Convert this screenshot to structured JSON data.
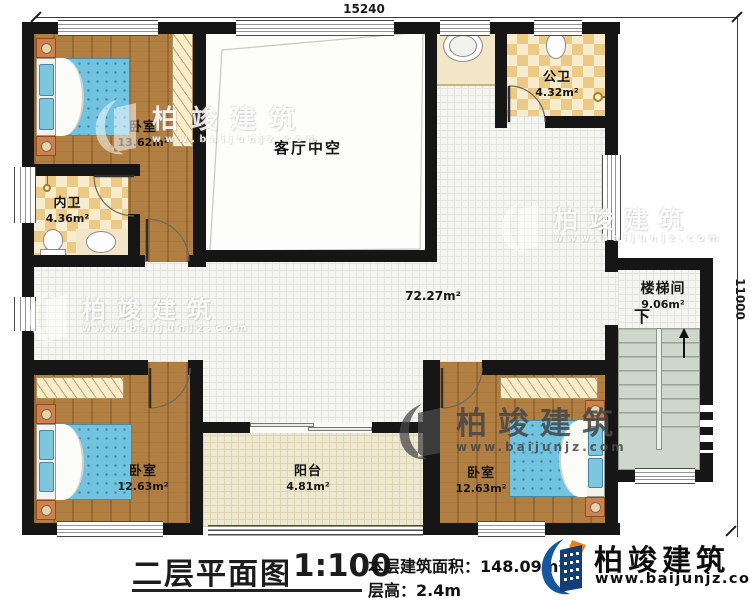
{
  "dimensions": {
    "top": "15240",
    "right": "11000"
  },
  "rooms": {
    "bedroom_tl": {
      "name": "卧室",
      "area": "13.62m²"
    },
    "inner_bath": {
      "name": "内卫",
      "area": "4.36m²"
    },
    "living_void": {
      "name": "客厅中空"
    },
    "public_bath": {
      "name": "公卫",
      "area": "4.32m²"
    },
    "hallway": {
      "area": "72.27m²"
    },
    "stairwell": {
      "name": "楼梯间",
      "area": "9.06m²",
      "down_label": "下"
    },
    "bedroom_bl": {
      "name": "卧室",
      "area": "12.63m²"
    },
    "balcony": {
      "name": "阳台",
      "area": "4.81m²"
    },
    "bedroom_br": {
      "name": "卧室",
      "area": "12.63m²"
    }
  },
  "title_block": {
    "plan_title": "二层平面图",
    "scale": "1:100",
    "floor_area_label": "本层建筑面积：",
    "floor_area_value": "148.09m²",
    "floor_height_label": "层高：",
    "floor_height_value": "2.4m"
  },
  "branding": {
    "company": "柏竣建筑",
    "website": "www.baijunjz.com"
  },
  "colors": {
    "wall": "#161616",
    "wood": "#b17f42",
    "checker": "#ecca86",
    "tile": "#f4f4f1",
    "bed": "#72c3e0",
    "logo_blue": "#1456a0",
    "logo_orange": "#e8831c"
  }
}
